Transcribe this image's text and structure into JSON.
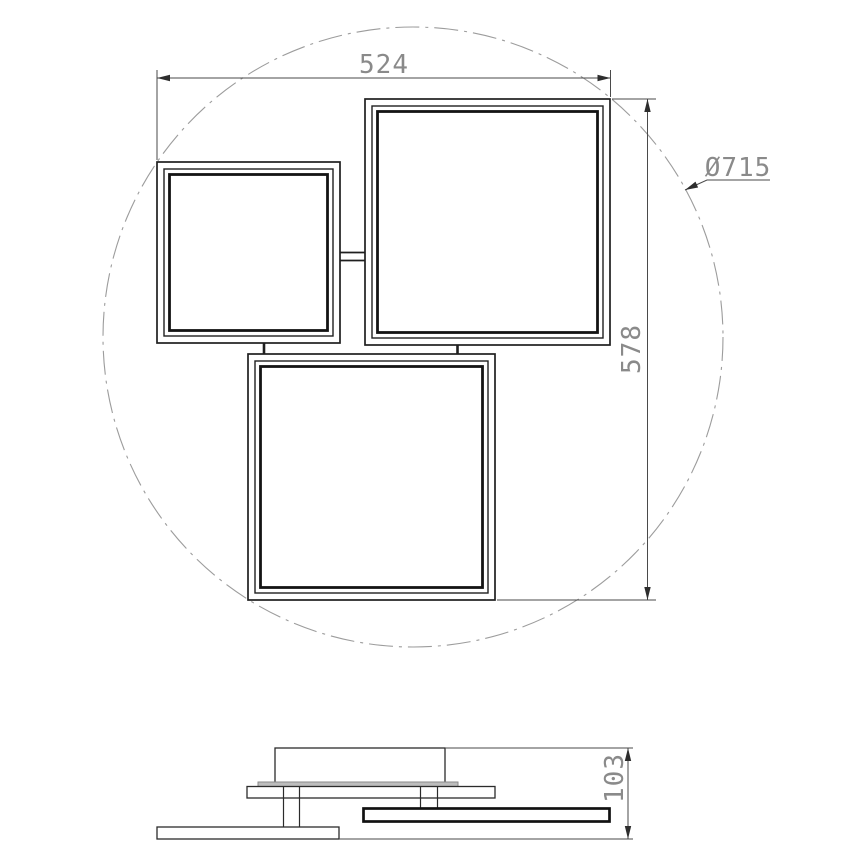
{
  "drawing": {
    "type": "technical-dimension-drawing",
    "labels": {
      "width": "524",
      "height": "578",
      "diameter": "Ø715",
      "thickness": "103"
    },
    "colors": {
      "outline": "#1f1f1f",
      "dimension_line": "#4a4a4a",
      "dimension_text": "#8a8a8a",
      "centerline_circle": "#9c9c9c",
      "mounting_strip": "#bdbdbd",
      "background": "#ffffff"
    }
  }
}
